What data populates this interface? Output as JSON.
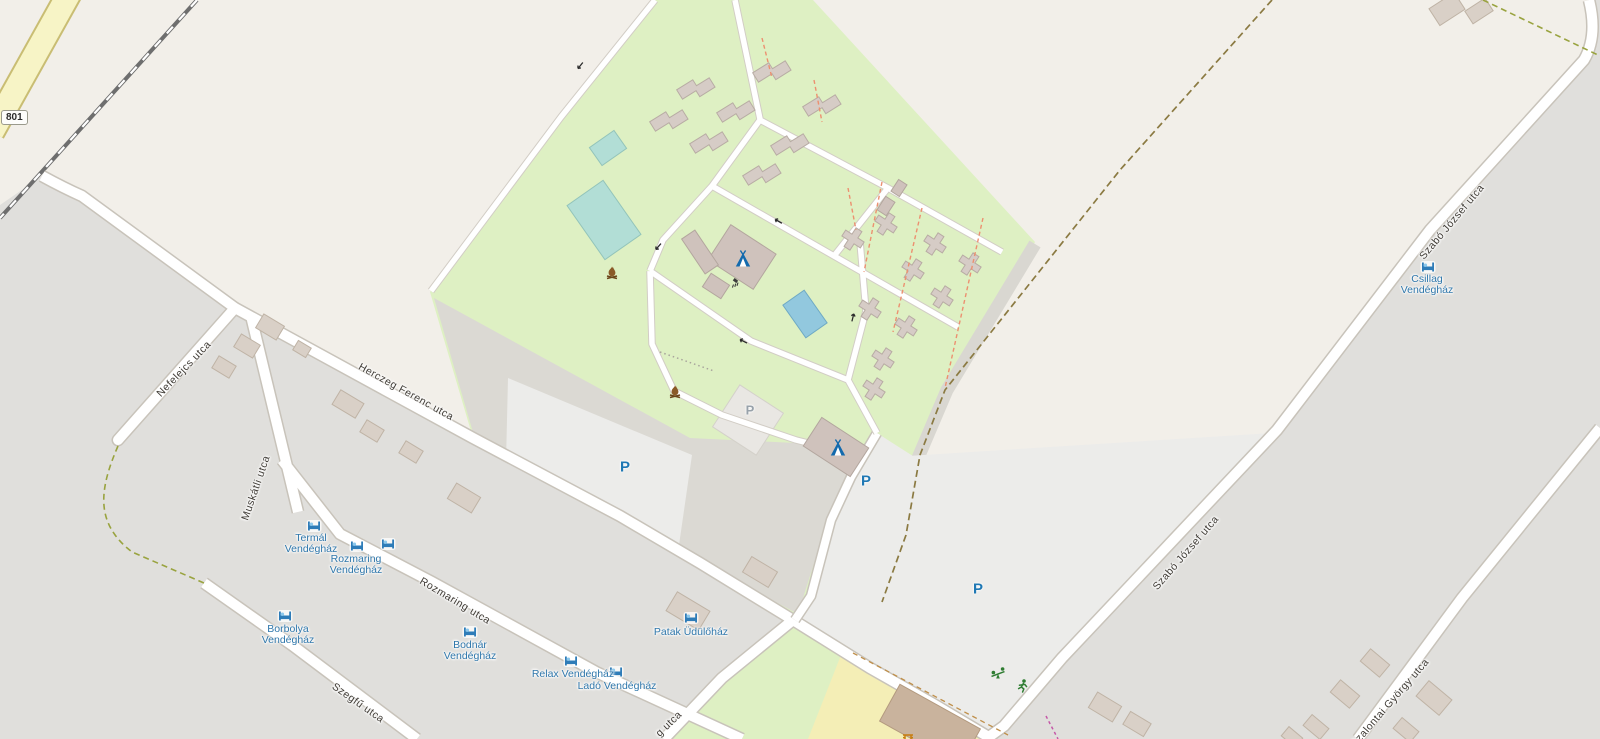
{
  "map": {
    "road_shield": {
      "ref": "801"
    },
    "streets": {
      "nefelejcs": "Nefelejcs utca",
      "muskatli": "Muskátli utca",
      "herczeg_ferenc": "Herczeg Ferenc utca",
      "rozmaring": "Rozmaring utca",
      "szegfu": "Szegfű utca",
      "szabo_jozsef_north": "Szabó József utca",
      "szabo_jozsef_mid": "Szabó József utca",
      "szalontai_gyorgy": "Szalontai György utca",
      "partial_bottom": "g utca"
    },
    "pois": {
      "termal": {
        "line1": "Termál",
        "line2": "Vendégház"
      },
      "rozmaring_vendeghaz": {
        "line1": "Rozmaring",
        "line2": "Vendégház"
      },
      "borbolya": {
        "line1": "Borbolya",
        "line2": "Vendégház"
      },
      "bodnar": {
        "line1": "Bodnár",
        "line2": "Vendégház"
      },
      "relax": {
        "line1": "Relax Vendégház"
      },
      "lado": {
        "line1": "Ladó Vendégház"
      },
      "patak": {
        "line1": "Patak Üdülőház"
      },
      "csillag": {
        "line1": "Csillag",
        "line2": "Vendégház"
      }
    },
    "parking_label": "P",
    "icons": {
      "guesthouse": "bed-icon",
      "campsite": "tent-icon",
      "campfire": "campfire-icon",
      "shower": "shower-icon",
      "playground": "playground-icon",
      "fitness": "runner-icon",
      "picnic": "picnic-table-icon",
      "oneway": "arrow-icon"
    },
    "palette": {
      "land": "#f2efe9",
      "residential": "#e0dfdc",
      "camp_green": "#def0c3",
      "parking_white": "#ececea",
      "road_fill": "#ffffff",
      "road_casing": "#c8c3ba",
      "secondary_road": "#f7f4c6",
      "pool_teal": "#b2ded6",
      "pool_blue": "#92c8de",
      "building": "#d9d0c7",
      "building_stroke": "#bfb3a5",
      "retail_yellow": "#f4eeb6",
      "track_gray": "#d9d7d1",
      "path_brown": "#8b7a42",
      "path_olive": "#99a33f",
      "footway_red": "#ec9070",
      "poi_blue": "#2f77ab",
      "street_text": "#3f3b35",
      "parking_blue": "#1f78b4",
      "railway": "#6e6e6e"
    }
  }
}
